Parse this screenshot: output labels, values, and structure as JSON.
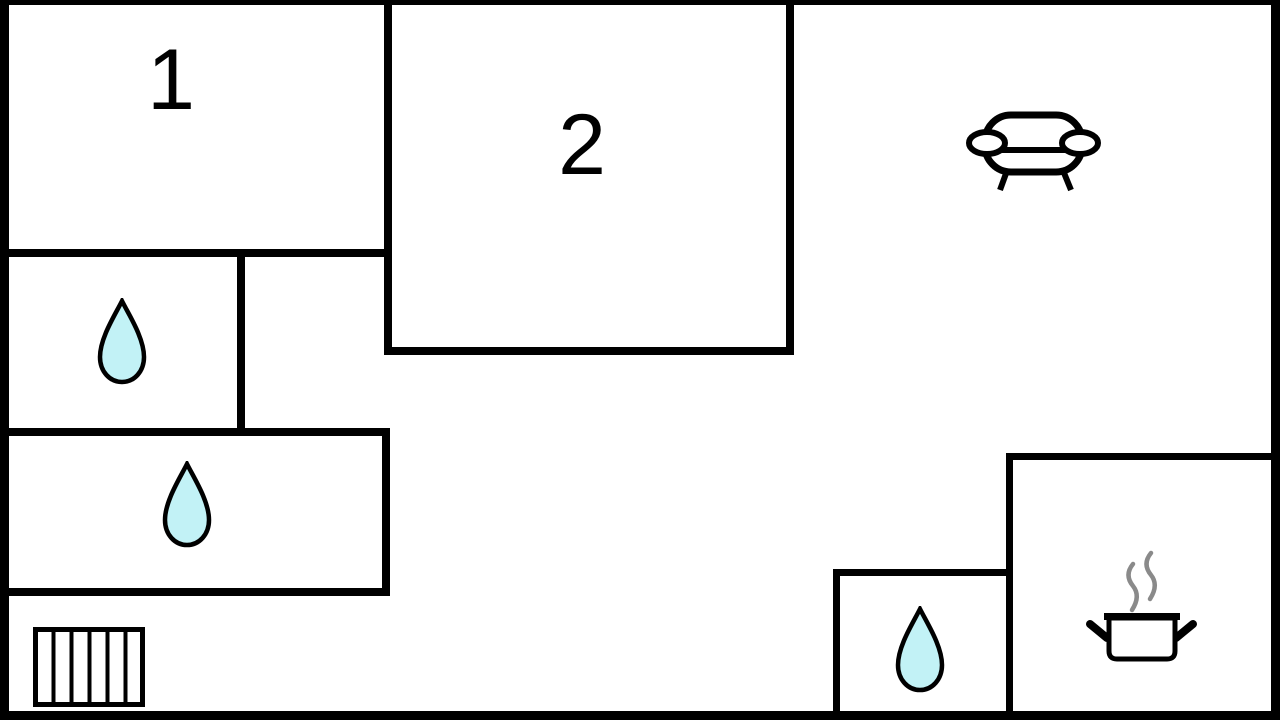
{
  "plan": {
    "type": "floor-plan",
    "rooms": [
      {
        "id": "room-1",
        "label": "1"
      },
      {
        "id": "room-2",
        "label": "2"
      }
    ],
    "colors": {
      "background": "#ffffff",
      "wall": "#000000",
      "water_drop_fill": "#c2f2f6",
      "water_drop_stroke": "#000000",
      "steam": "#8a8a8a",
      "icon_stroke": "#000000"
    },
    "icons": [
      {
        "name": "water-drop-icon",
        "count": 3
      },
      {
        "name": "sofa-icon",
        "count": 1
      },
      {
        "name": "stairs-icon",
        "count": 1
      },
      {
        "name": "cooking-pot-icon",
        "count": 1
      }
    ]
  }
}
